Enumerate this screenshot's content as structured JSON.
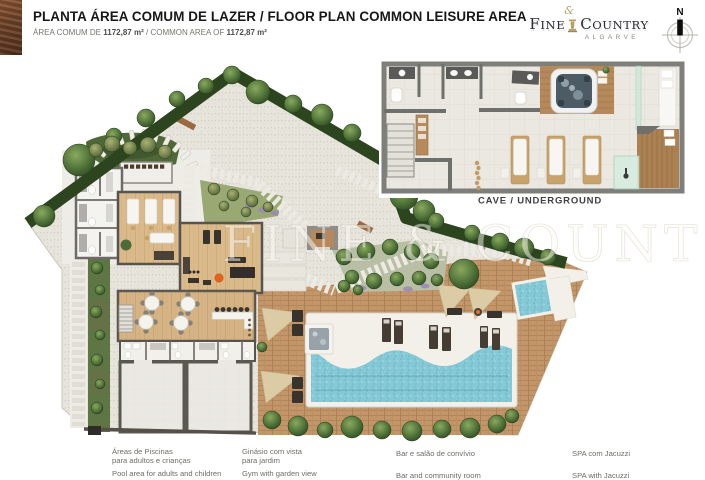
{
  "header": {
    "title": "PLANTA ÁREA COMUM DE LAZER / FLOOR PLAN COMMON LEISURE AREA",
    "area_pt_label": "ÁREA COMUM DE",
    "area_pt_value": "1172,87 m²",
    "separator": "/",
    "area_en_label": "COMMON AREA OF",
    "area_en_value": "1172,87 m²"
  },
  "logo": {
    "brand_first": "FINE",
    "brand_amp": "&",
    "brand_second": "COUNTRY",
    "region": "ALGARVE"
  },
  "compass": {
    "north_label": "N"
  },
  "inset": {
    "label": "CAVE / UNDERGROUND"
  },
  "watermark": {
    "text": "FINE & COUNTRY"
  },
  "legend": {
    "items": [
      {
        "pt_lines": [
          "Áreas de Piscinas",
          "para adultos e crianças"
        ],
        "en": "Pool area for adults and children"
      },
      {
        "pt_lines": [
          "Ginásio com vista",
          "para jardim"
        ],
        "en": "Gym with garden view"
      },
      {
        "pt_lines": [
          "Bar e salão de convívio"
        ],
        "en": "Bar and community room"
      },
      {
        "pt_lines": [
          "SPA com Jacuzzi"
        ],
        "en": "SPA with Jacuzzi"
      }
    ]
  },
  "colors": {
    "accent_brown": "#6b3f24",
    "hedge_green": "#2c451f",
    "garden_green": "#4f6838",
    "gravel": "#e7e4dc",
    "deck_wood": "#c29668",
    "interior_wood": "#daba8b",
    "pool_water": "#85c8d6",
    "jacuzzi_water": "#4c5b64",
    "white_deck": "#f2f0e9",
    "sail_beige": "#dbcca6",
    "wall_gray": "#7e7e7a",
    "logo_gold": "#b49e62",
    "logo_dark": "#2e2c35"
  }
}
